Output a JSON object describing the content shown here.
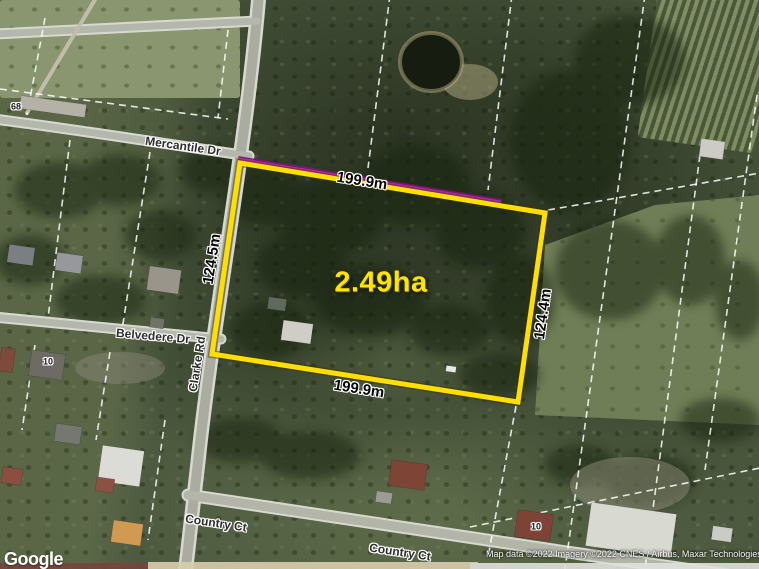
{
  "map": {
    "annotation": {
      "area": "2.49ha",
      "side_top": "199.9m",
      "side_bottom": "199.9m",
      "side_left": "124.5m",
      "side_right": "124.4m",
      "boundary_color": "#ffdf00",
      "frontage_color": "#c226b4"
    },
    "streets": {
      "mercantile_dr": "Mercantile Dr",
      "clarke_rd": "Clarke Rd",
      "belvedere_dr": "Belvedere Dr",
      "country_ct_upper": "Country Ct",
      "country_ct_lower": "Country Ct"
    },
    "house_numbers": {
      "lot_68": "68",
      "lot_10_west": "10",
      "lot_10_east": "10"
    },
    "footer": {
      "logo": "Google",
      "attribution": "Map data ©2022 Imagery ©2022 CNES / Airbus, Maxar Technologies"
    }
  }
}
